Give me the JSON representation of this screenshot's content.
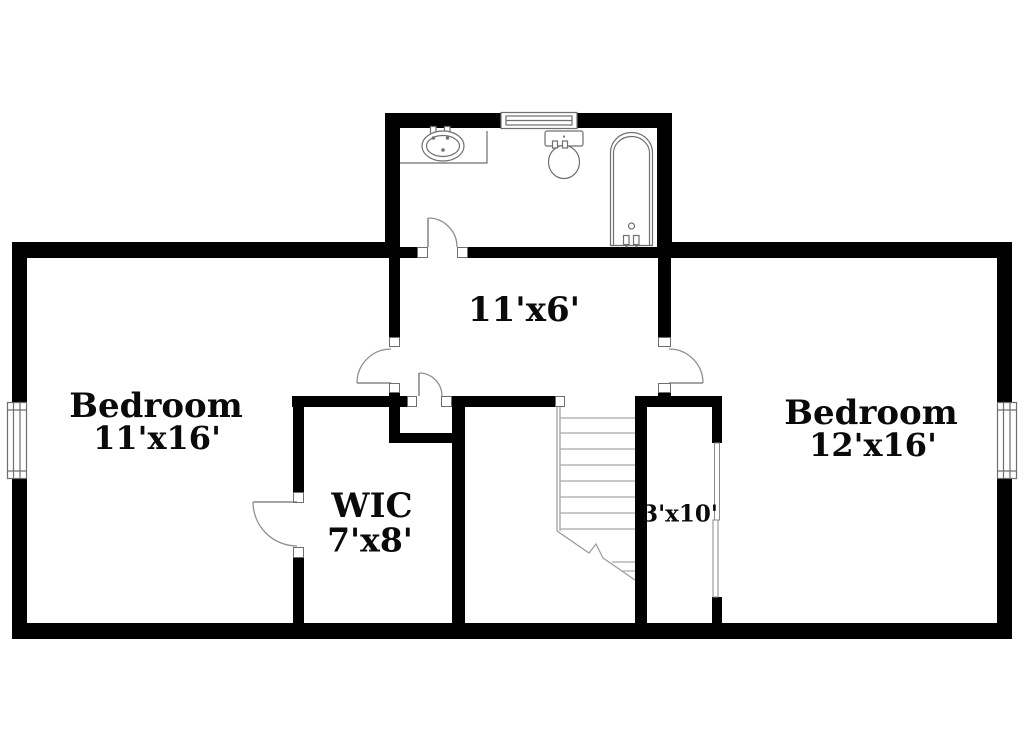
{
  "rooms": {
    "bedroom_left": {
      "label": "Bedroom",
      "dims": "11'x16'"
    },
    "bedroom_right": {
      "label": "Bedroom",
      "dims": "12'x16'"
    },
    "wic": {
      "label": "WIC",
      "dims": "7'x8'"
    },
    "hall": {
      "dims": "11'x6'"
    },
    "stair_closet": {
      "dims": "3'x10'"
    }
  },
  "fixtures": {
    "bathroom": [
      "sink",
      "toilet",
      "bathtub",
      "window"
    ],
    "stairwell": [
      "staircase"
    ],
    "exterior": [
      "window-left",
      "window-right",
      "window-stair-closet"
    ]
  },
  "colors": {
    "wall": "#000000",
    "background": "#ffffff",
    "fixture_line": "#6f6f6f",
    "door_line": "#8f8f8f",
    "stair_line": "#a8a8a8",
    "text": "#0a0a0a"
  }
}
